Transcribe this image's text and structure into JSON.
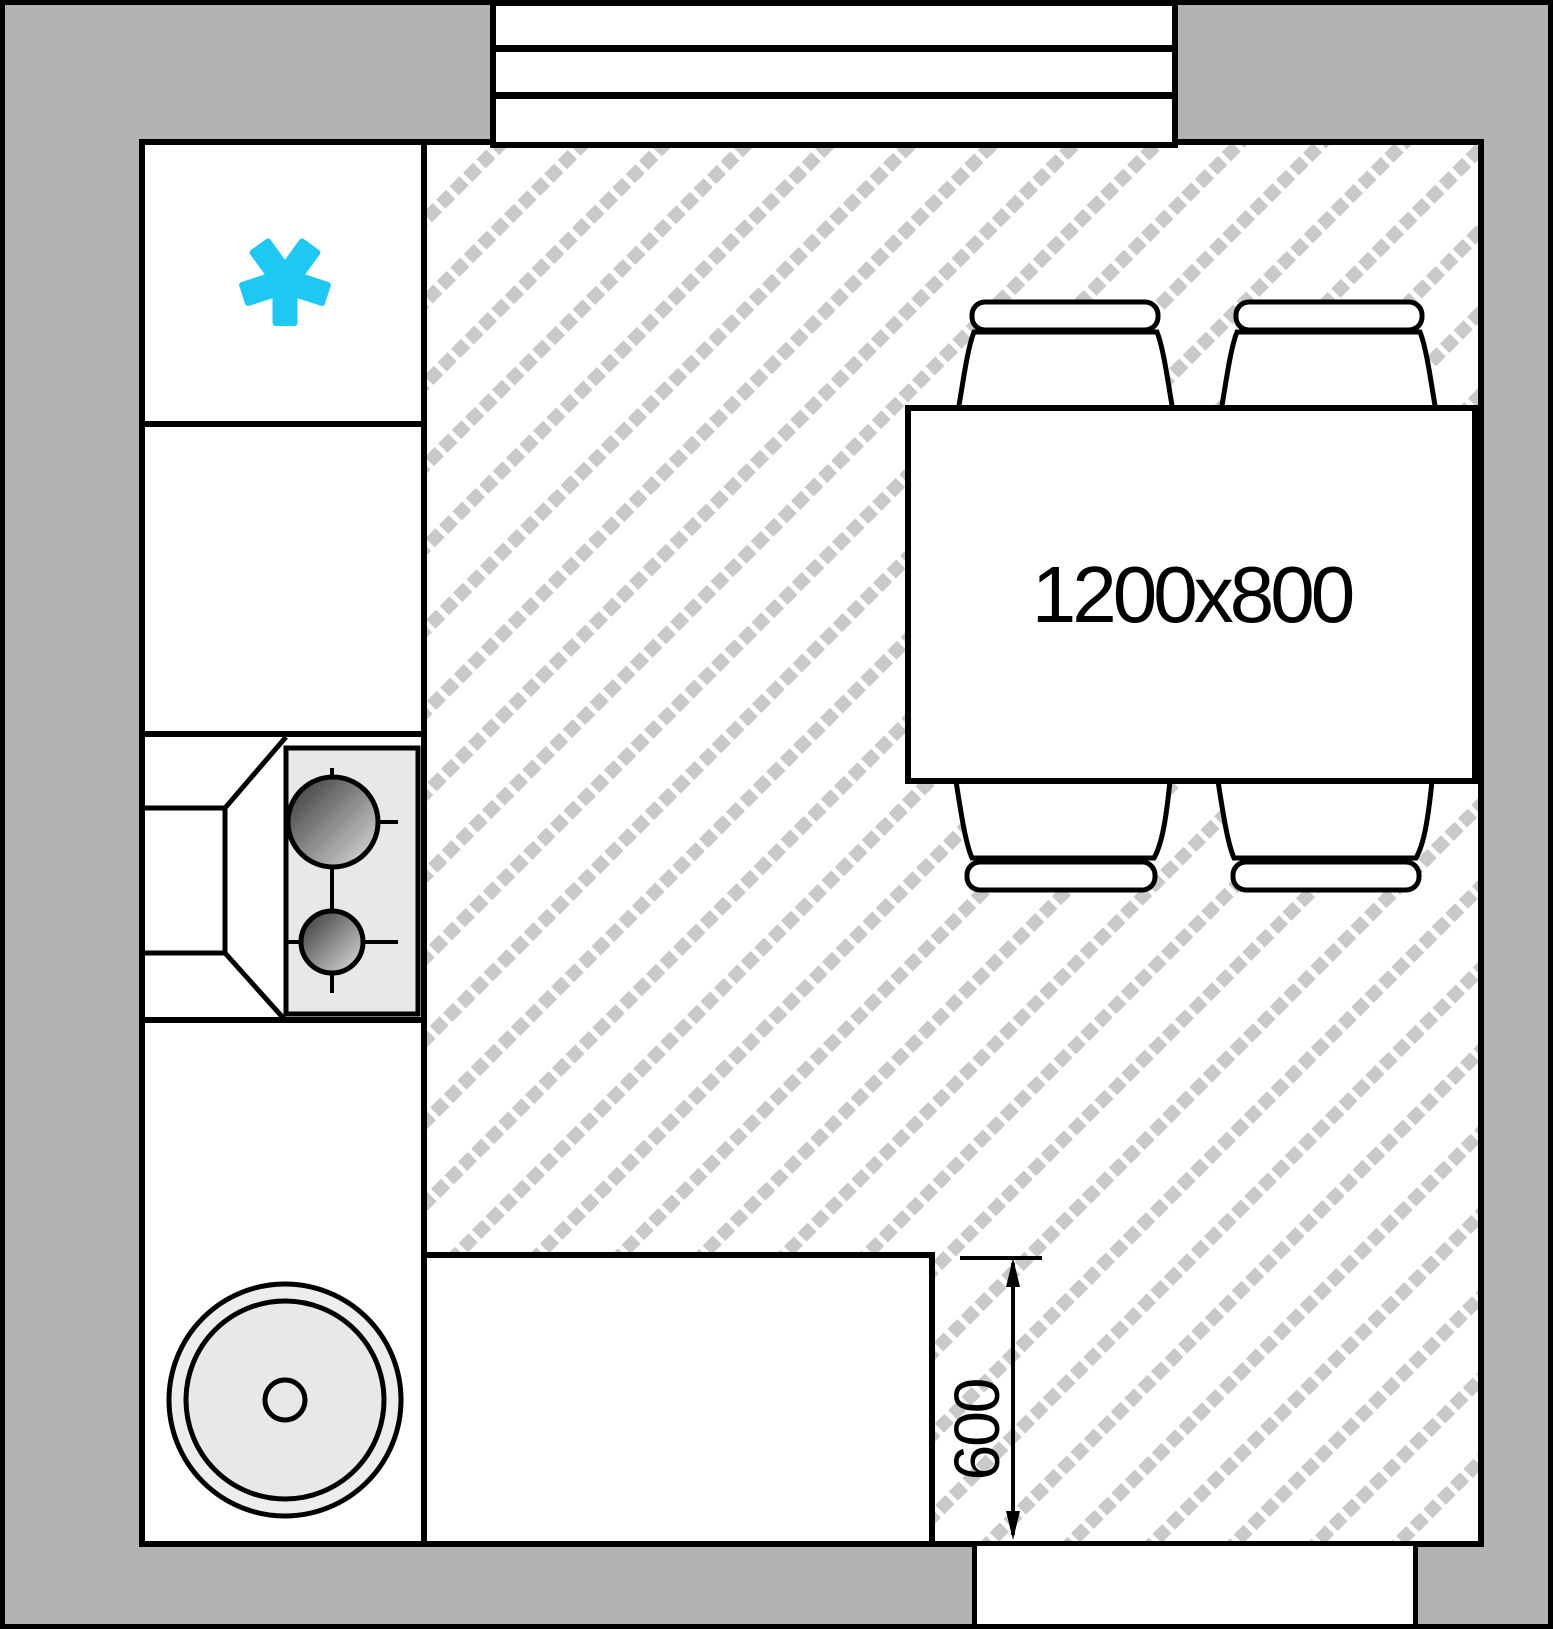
{
  "document": {
    "type": "kitchen-floor-plan"
  },
  "labels": {
    "table_size": "1200x800",
    "counter_depth": "600"
  },
  "colors": {
    "wall": "#b2b2b2",
    "outline": "#000000",
    "hatch_dot": "#c9c9c9",
    "appliance_fill": "#e8e8e8",
    "freezer_icon": "#1ec8f2"
  },
  "fixtures": {
    "window": "window-three-line",
    "door": "door-opening-bottom-right",
    "freezer": "freezer-asterisk-icon",
    "stove": "two-burner-cooktop",
    "sink": "round-sink",
    "table": "dining-table",
    "chairs_count": 4
  }
}
